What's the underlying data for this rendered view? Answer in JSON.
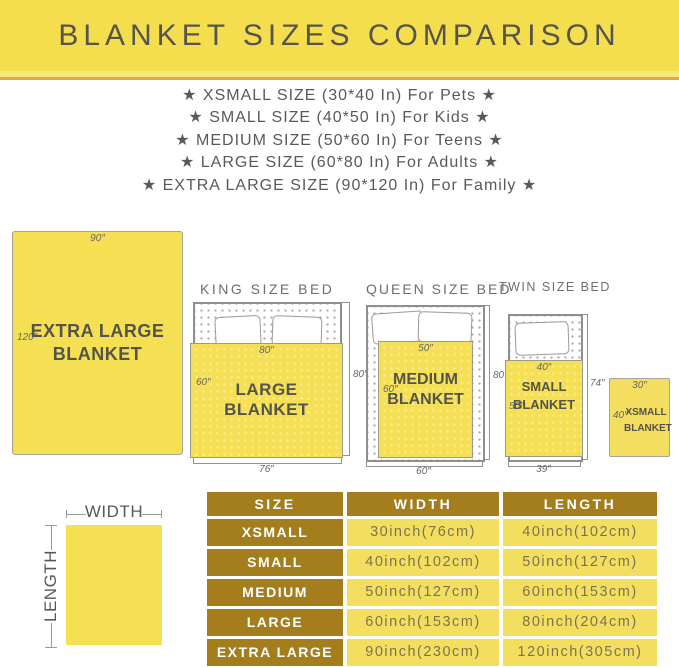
{
  "banner": {
    "title": "BLANKET SIZES COMPARISON"
  },
  "size_list": [
    "★  XSMALL SIZE (30*40 In) For Pets  ★",
    "★  SMALL SIZE (40*50 In) For Kids  ★",
    "★  MEDIUM SIZE (50*60 In) For Teens  ★",
    "★  LARGE SIZE (60*80 In) For Adults  ★",
    "★  EXTRA LARGE SIZE (90*120 In) For Family  ★"
  ],
  "diagrams": {
    "extra_large_blanket": {
      "name": "EXTRA LARGE BLANKET",
      "width_label": "90″",
      "length_label": "120″"
    },
    "king_bed": {
      "title": "KING SIZE BED",
      "blanket_name": "LARGE BLANKET",
      "blanket_width_label": "80″",
      "blanket_length_label": "60″",
      "bed_length_label": "80″",
      "bed_width_label": "76″"
    },
    "queen_bed": {
      "title": "QUEEN SIZE BED",
      "blanket_name": "MEDIUM BLANKET",
      "blanket_width_label": "50″",
      "blanket_length_label": "60″",
      "bed_length_label": "80″",
      "bed_width_label": "60″"
    },
    "twin_bed": {
      "title": "TWIN SIZE BED",
      "blanket_name": "SMALL BLANKET",
      "blanket_width_label": "40″",
      "blanket_length_label": "50″",
      "bed_length_label": "74″",
      "bed_width_label": "39″"
    },
    "xsmall_blanket": {
      "name": "XSMALL BLANKET",
      "width_label": "30″",
      "length_label": "40″"
    }
  },
  "legend": {
    "width_label": "WIDTH",
    "length_label": "LENGTH"
  },
  "table": {
    "headers": [
      "SIZE",
      "WIDTH",
      "LENGTH"
    ],
    "rows": [
      [
        "XSMALL",
        "30inch(76cm)",
        "40inch(102cm)"
      ],
      [
        "SMALL",
        "40inch(102cm)",
        "50inch(127cm)"
      ],
      [
        "MEDIUM",
        "50inch(127cm)",
        "60inch(153cm)"
      ],
      [
        "LARGE",
        "60inch(153cm)",
        "80inch(204cm)"
      ],
      [
        "EXTRA LARGE",
        "90inch(230cm)",
        "120inch(305cm)"
      ]
    ]
  },
  "colors": {
    "banner_yellow": "#F5DE4E",
    "accent_orange": "#E9A43C",
    "blanket_yellow": "#F5DF55",
    "table_header_gold": "#A47D1C",
    "table_cell_yellow": "#F3DE5F"
  }
}
